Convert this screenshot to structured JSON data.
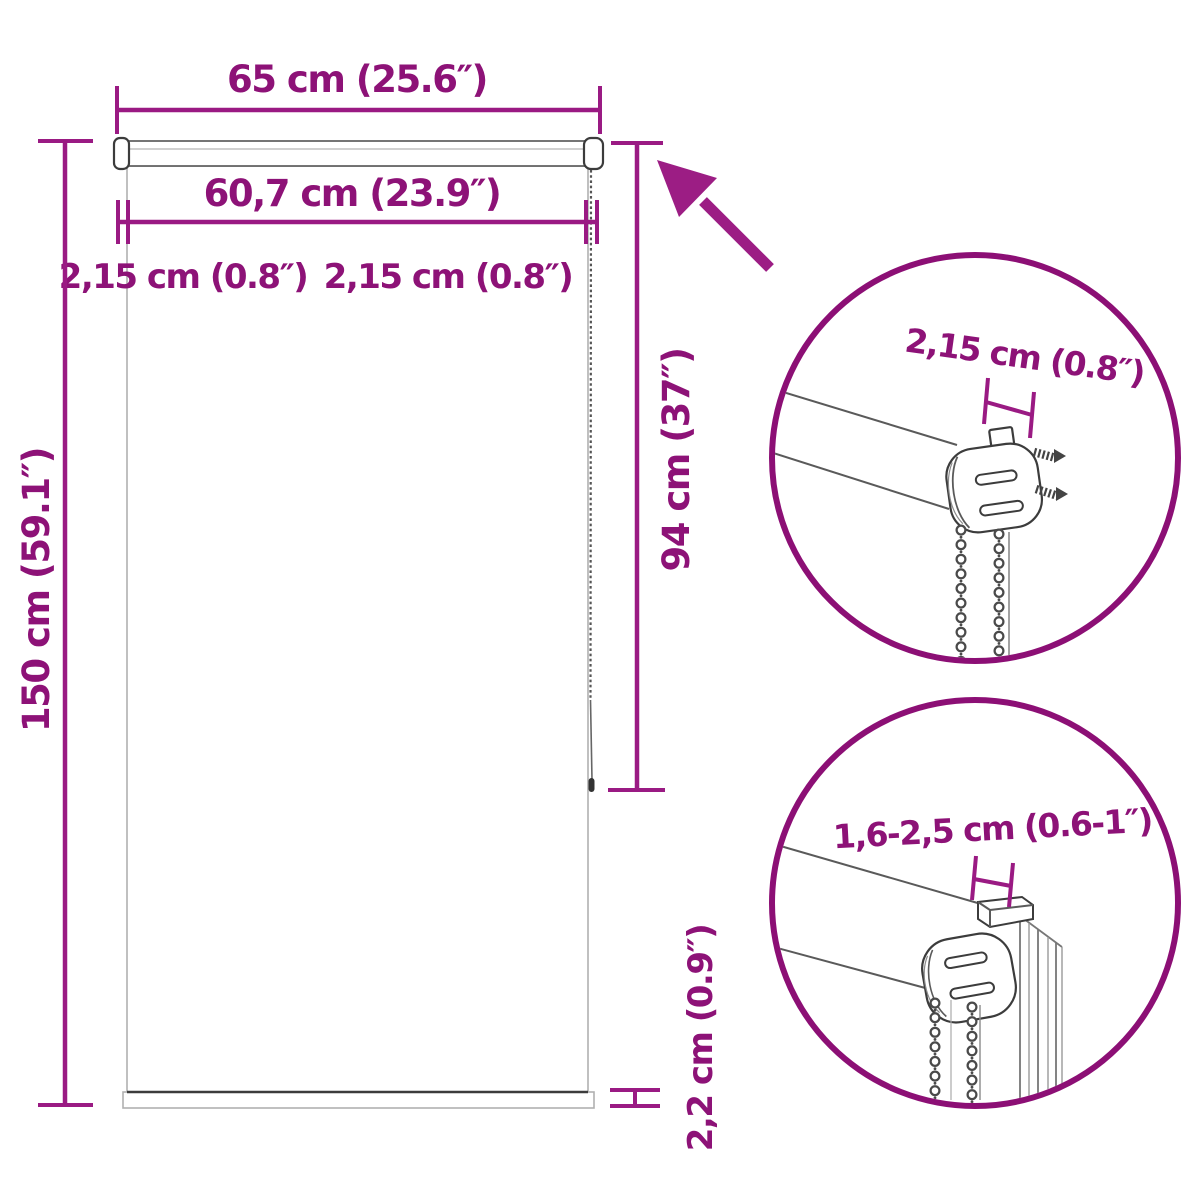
{
  "colors": {
    "accent_purple_lines": "#9a1a83",
    "accent_purple_text": "#8d1277",
    "detail_circle_stroke": "#8c0f75",
    "drawing_gray": "#5a5a5a",
    "background": "#ffffff"
  },
  "diagram": {
    "type": "roller-blind-dimension-diagram",
    "dimensions": {
      "total_width": "65 cm (25.6″)",
      "fabric_width": "60,7 cm (23.9″)",
      "left_offset": "2,15 cm (0.8″)",
      "right_offset": "2,15 cm (0.8″)",
      "total_height": "150 cm (59.1″)",
      "chain_length": "94 cm (37″)",
      "bottom_bar_height": "2,2 cm (0.9″)"
    },
    "detail_circle_top": {
      "dimension": "2,15 cm (0.8″)"
    },
    "detail_circle_bottom": {
      "dimension": "1,6-2,5 cm (0.6-1″)"
    }
  }
}
